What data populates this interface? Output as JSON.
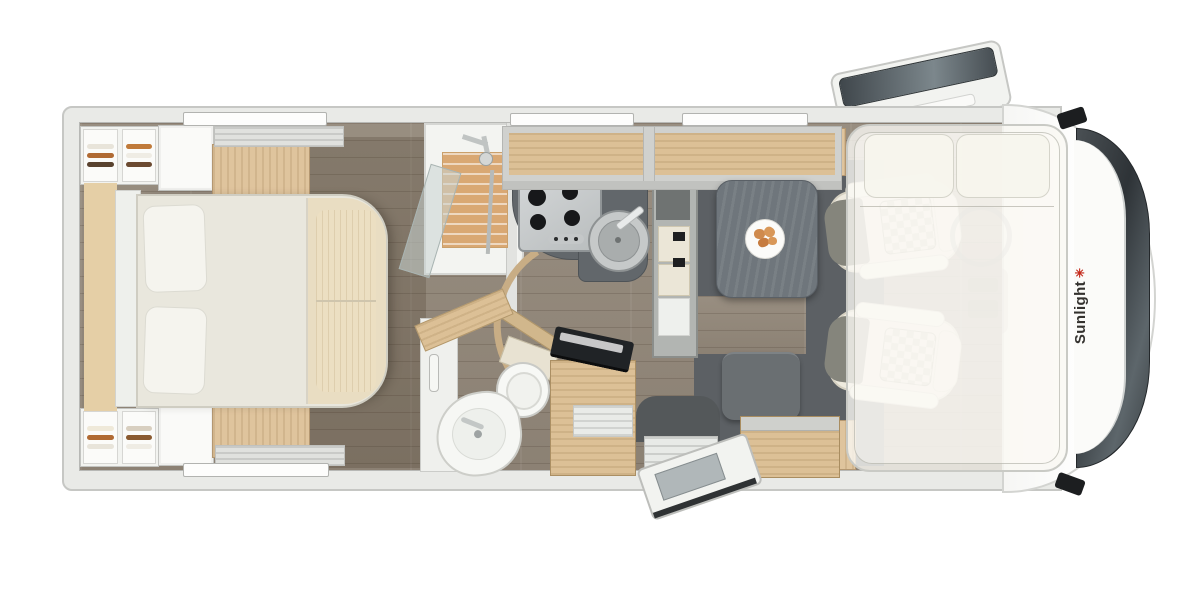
{
  "scene": {
    "type": "motorhome floor plan, top-down 3D render",
    "background_color": "#ffffff"
  },
  "brand": {
    "logo_text": "Sunlight",
    "logo_symbol": "✳",
    "logo_text_color": "#34322f",
    "logo_symbol_color": "#c42a1c"
  },
  "palette": {
    "body_wall": "#e9eae7",
    "floor_wood": "#93887a",
    "bedroom_floor_shade": "#7e7265",
    "furniture_wood_light": "#dfc49d",
    "kitchen_counter": "#62676b",
    "dinette_mat": "#5c6064",
    "table_top": "#6f767c",
    "bed_linen": "#e9e7dd",
    "bed_foot_panel": "#e9ddc2",
    "glass_dark": "#3f464b",
    "seat_cream": "#eeeade",
    "seat_checker": "#c9c3b1",
    "accent_red": "#c42a1c"
  },
  "fixtures": [
    {
      "name": "rear-wardrobe-top",
      "contents": "folded-clothes"
    },
    {
      "name": "rear-wardrobe-bottom",
      "contents": "folded-clothes"
    },
    {
      "name": "island-bed",
      "pillows": 2
    },
    {
      "name": "roof-vent-top"
    },
    {
      "name": "roof-vent-bottom"
    },
    {
      "name": "shower-cabin",
      "floor": "wood-slat-mat"
    },
    {
      "name": "gas-hob",
      "burners": 4
    },
    {
      "name": "round-sink"
    },
    {
      "name": "tall-cabinet-fridge"
    },
    {
      "name": "overhead-lockers"
    },
    {
      "name": "dinette-table",
      "decor": "plate-of-croissants"
    },
    {
      "name": "side-bench-seat"
    },
    {
      "name": "corner-washbasin"
    },
    {
      "name": "toilet"
    },
    {
      "name": "tv-cabinet",
      "decor": "flatscreen-tv"
    },
    {
      "name": "entry-door",
      "state": "open"
    },
    {
      "name": "entry-step"
    },
    {
      "name": "cab-seat-top",
      "style": "swivel-captain-chair"
    },
    {
      "name": "cab-seat-bottom",
      "style": "swivel-captain-chair"
    },
    {
      "name": "drop-down-bed",
      "pillows": 2,
      "state": "translucent-overlay"
    },
    {
      "name": "roof-hatch",
      "state": "open"
    },
    {
      "name": "wing-mirror-top"
    },
    {
      "name": "wing-mirror-bottom"
    },
    {
      "name": "windshield"
    },
    {
      "name": "side-windows",
      "count": 4
    }
  ]
}
